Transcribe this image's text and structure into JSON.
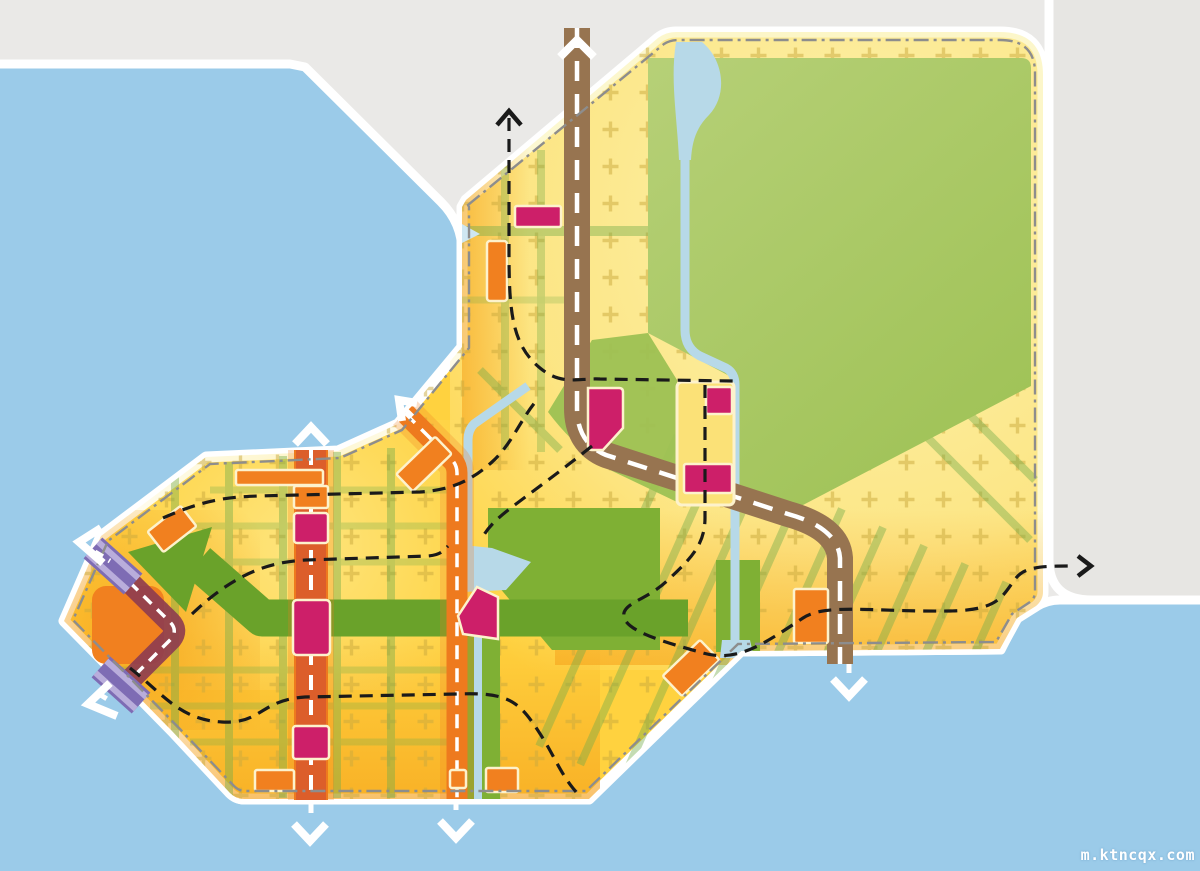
{
  "watermark": {
    "text": "m.ktncqx.com"
  },
  "palette": {
    "background": "#eae9e7",
    "sea": "#9bcbe9",
    "mainland": "#e7e6e3",
    "coast_band": "#ffffff",
    "site_yellow": "#ffd23f",
    "site_pale": "#fbf3b4",
    "mid_pale": "#fdeb92",
    "coast_glow": "#f5a019",
    "park_light": "#b6d077",
    "park_dark": "#9dc153",
    "corridor_green": "#7fb034",
    "arrow_green": "#6aa22a",
    "grid_green": "#74ad4a",
    "canal_blue": "#b7d9e8",
    "road_brown": "#977450",
    "road_orange": "#ee7a1e",
    "road_red_tint": "#c94136",
    "road_maroon": "#8d3b50",
    "transit_purple": "#7e6cb4",
    "transit_purple_light": "#b9addb",
    "block_magenta": "#cd1f69",
    "block_orange": "#f1801f",
    "block_outline": "#fdf2cc",
    "plus_marks": "#c9a93d",
    "boundary_gray": "#8d8d8d",
    "route_black": "#1a1a1a",
    "arrow_white": "#ffffff"
  },
  "exits": [
    {
      "name": "boulevard-north",
      "direction": "north"
    },
    {
      "name": "avenue-west-north",
      "direction": "north"
    },
    {
      "name": "avenue-west-south",
      "direction": "south"
    },
    {
      "name": "avenue-center-northwest",
      "direction": "northwest"
    },
    {
      "name": "avenue-center-south",
      "direction": "south"
    },
    {
      "name": "boulevard-southeast",
      "direction": "south"
    },
    {
      "name": "transit-purple-northwest",
      "direction": "northwest"
    },
    {
      "name": "transit-purple-southwest",
      "direction": "southwest"
    },
    {
      "name": "route-north",
      "direction": "north"
    },
    {
      "name": "route-east",
      "direction": "east"
    }
  ]
}
